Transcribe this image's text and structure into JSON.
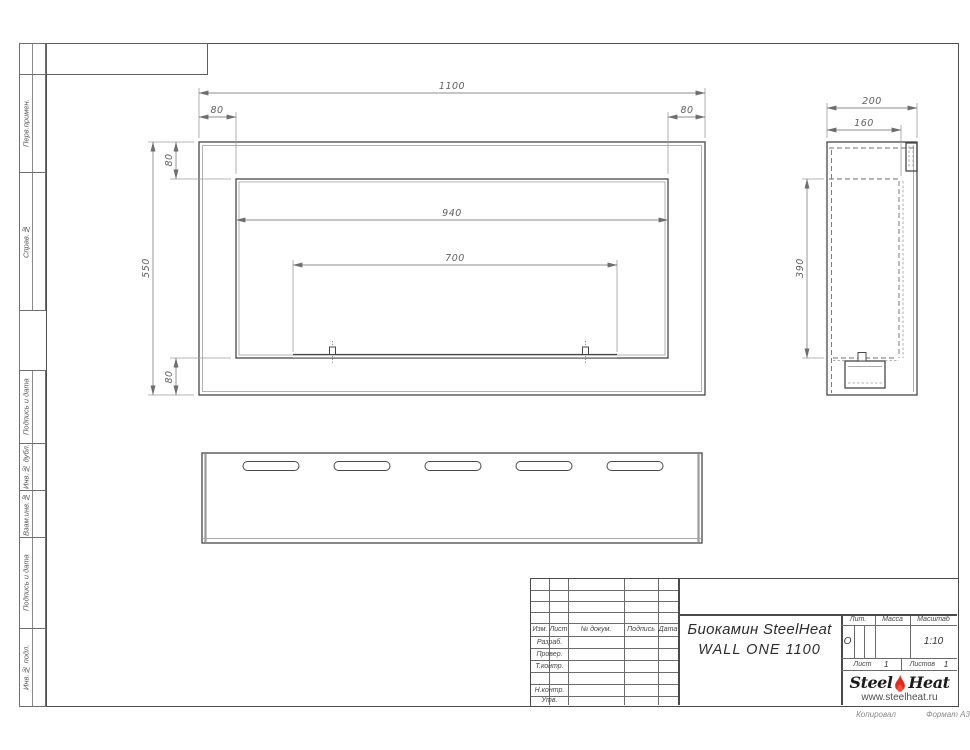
{
  "sheet": {
    "copied_label": "Копировал",
    "format_label": "Формат А3"
  },
  "left_stamps": [
    "Перв.примен.",
    "Справ.№",
    "Подпись и дата",
    "Инв.№ дубл.",
    "Взам.инв.№",
    "Подпись и дата",
    "Инв.№ подл."
  ],
  "front_view": {
    "dims": {
      "total_width": "1100",
      "left_margin": "80",
      "right_margin": "80",
      "top_margin": "80",
      "total_height": "550",
      "bottom_margin": "80",
      "opening_width": "940",
      "burner_width": "700"
    }
  },
  "side_view": {
    "dims": {
      "total_depth": "200",
      "inner_depth": "160",
      "inner_height": "390"
    }
  },
  "title_block": {
    "cols": {
      "izm": "Изм.",
      "list": "Лист",
      "dokum": "№ докум.",
      "podpis": "Подпись",
      "data": "Дата"
    },
    "rows": {
      "razrab": "Разраб.",
      "prover": "Провер.",
      "tkontr": "Т.контр.",
      "nkontr": "Н.контр.",
      "utv": "Утв."
    },
    "title_line1": "Биокамин SteelHeat",
    "title_line2": "WALL ONE 1100",
    "lit_label": "Лит.",
    "lit_value": "О",
    "mass_label": "Масса",
    "scale_label": "Масштаб",
    "scale_value": "1:10",
    "sheet_label": "Лист",
    "sheet_value": "1",
    "sheets_label": "Листов",
    "sheets_value": "1",
    "logo": {
      "steel": "Steel",
      "heat": "Heat",
      "url": "www.steelheat.ru"
    }
  },
  "colors": {
    "flame_red": "#e02b20"
  }
}
